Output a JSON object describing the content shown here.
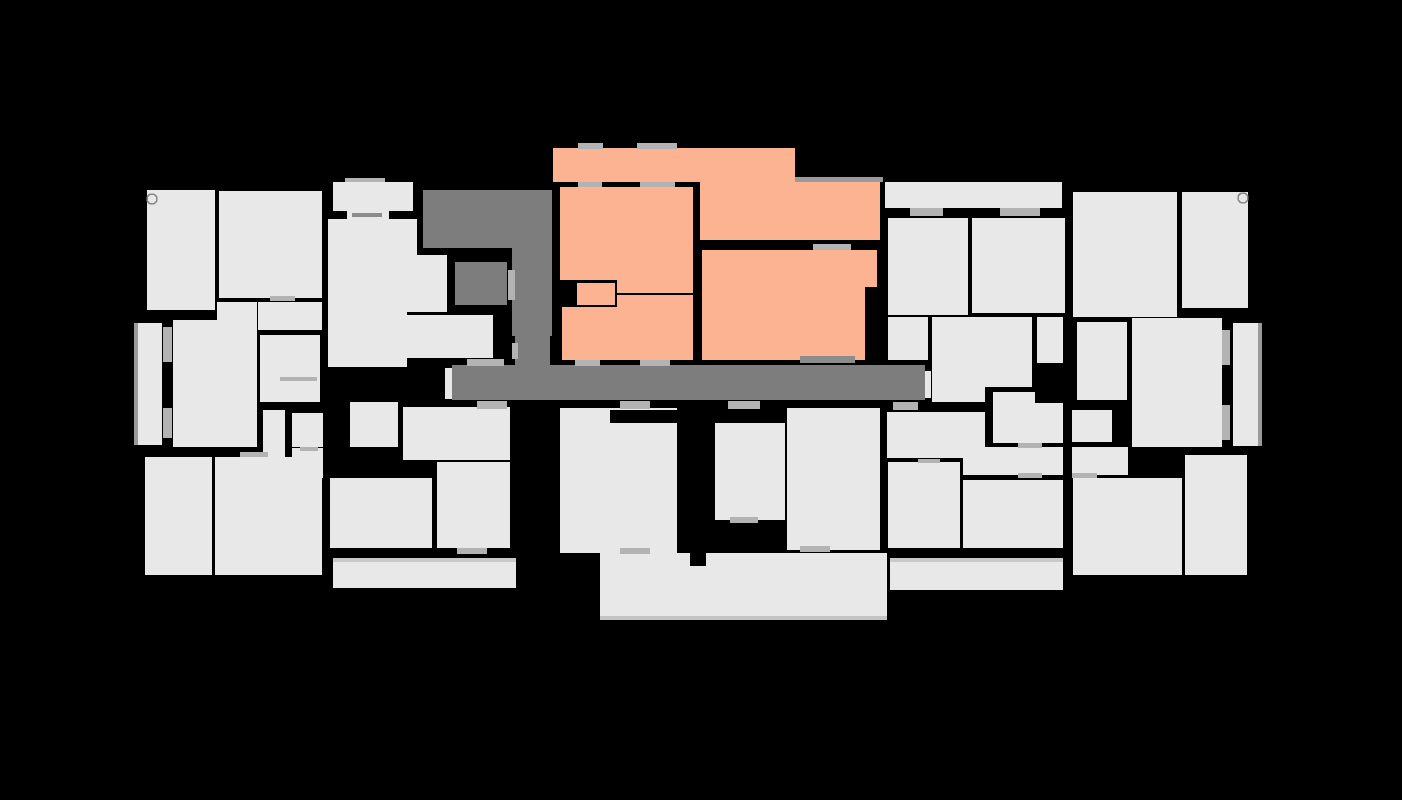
{
  "canvas": {
    "width": 1402,
    "height": 800,
    "background": "#000000"
  },
  "palette": {
    "room": "#e8e8e8",
    "common": "#7d7d7d",
    "unit": "#fbb391",
    "wall": "#000000",
    "door": "#b3b3b3",
    "door_dark": "#8c8c8c",
    "shade": "#9a9a9a",
    "trim": "#c9c9c9",
    "trim_bottom": "#c4c4c4",
    "circle_stroke": "#888888"
  },
  "floorplan": {
    "selected_unit": {
      "id": "unit-orange",
      "color": "#fbb391",
      "room_ids": [
        "u-hall",
        "u-room-ne",
        "u-bedroom",
        "u-wc",
        "u-bath",
        "u-kitchen",
        "u-living"
      ]
    },
    "rooms": [
      {
        "id": "u-hall",
        "kind": "unit",
        "shape": "rect",
        "x": 553,
        "y": 148,
        "w": 242,
        "h": 34
      },
      {
        "id": "u-room-ne",
        "kind": "unit",
        "shape": "rect",
        "x": 700,
        "y": 182,
        "w": 180,
        "h": 58
      },
      {
        "id": "u-bedroom",
        "kind": "unit",
        "shape": "poly",
        "points": "560,187 693,187 693,293 617,293 617,280 560,280"
      },
      {
        "id": "u-wc",
        "kind": "unit",
        "shape": "rect",
        "x": 577,
        "y": 283,
        "w": 38,
        "h": 22
      },
      {
        "id": "u-bath",
        "kind": "unit",
        "shape": "rect",
        "x": 562,
        "y": 307,
        "w": 55,
        "h": 53
      },
      {
        "id": "u-kitchen",
        "kind": "unit",
        "shape": "rect",
        "x": 617,
        "y": 295,
        "w": 76,
        "h": 65
      },
      {
        "id": "u-living",
        "kind": "unit",
        "shape": "poly",
        "points": "702,250 877,250 877,287 865,287 865,360 702,360"
      },
      {
        "id": "c-hall-nw",
        "kind": "common",
        "shape": "rect",
        "x": 423,
        "y": 190,
        "w": 94,
        "h": 58
      },
      {
        "id": "c-strip",
        "kind": "common",
        "shape": "rect",
        "x": 512,
        "y": 190,
        "w": 40,
        "h": 146
      },
      {
        "id": "c-block",
        "kind": "common",
        "shape": "rect",
        "x": 455,
        "y": 262,
        "w": 52,
        "h": 43
      },
      {
        "id": "c-stub",
        "kind": "common",
        "shape": "rect",
        "x": 515,
        "y": 336,
        "w": 35,
        "h": 30
      },
      {
        "id": "c-corridor",
        "kind": "common",
        "shape": "rect",
        "x": 452,
        "y": 365,
        "w": 473,
        "h": 35
      },
      {
        "id": "room-a",
        "kind": "room",
        "shape": "rect",
        "x": 147,
        "y": 190,
        "w": 68,
        "h": 120
      },
      {
        "id": "room-a2",
        "kind": "room",
        "shape": "rect",
        "x": 137,
        "y": 323,
        "w": 25,
        "h": 122
      },
      {
        "id": "room-b",
        "kind": "room",
        "shape": "rect",
        "x": 219,
        "y": 191,
        "w": 103,
        "h": 107
      },
      {
        "id": "room-ctop",
        "kind": "room",
        "shape": "rect",
        "x": 333,
        "y": 182,
        "w": 80,
        "h": 29
      },
      {
        "id": "room-cconn",
        "kind": "room",
        "shape": "rect",
        "x": 347,
        "y": 211,
        "w": 42,
        "h": 10
      },
      {
        "id": "room-d",
        "kind": "room",
        "shape": "poly",
        "points": "328,219 417,219 417,255 447,255 447,312 407,312 407,367 328,367"
      },
      {
        "id": "room-e",
        "kind": "room",
        "shape": "poly",
        "points": "217,302 257,302 257,447 173,447 173,320 217,320"
      },
      {
        "id": "room-f",
        "kind": "room",
        "shape": "rect",
        "x": 258,
        "y": 302,
        "w": 64,
        "h": 28
      },
      {
        "id": "room-g",
        "kind": "room",
        "shape": "rect",
        "x": 260,
        "y": 335,
        "w": 60,
        "h": 67
      },
      {
        "id": "room-sq1",
        "kind": "room",
        "shape": "rect",
        "x": 292,
        "y": 413,
        "w": 31,
        "h": 34
      },
      {
        "id": "room-sq2",
        "kind": "room",
        "shape": "rect",
        "x": 292,
        "y": 448,
        "w": 31,
        "h": 30
      },
      {
        "id": "room-x",
        "kind": "room",
        "shape": "rect",
        "x": 407,
        "y": 315,
        "w": 86,
        "h": 43
      },
      {
        "id": "room-l9",
        "kind": "room",
        "shape": "rect",
        "x": 145,
        "y": 457,
        "w": 67,
        "h": 118
      },
      {
        "id": "room-l10",
        "kind": "room",
        "shape": "poly",
        "points": "263,410 285,410 285,457 322,457 322,575 215,575 215,457 263,457"
      },
      {
        "id": "room-m1",
        "kind": "room",
        "shape": "rect",
        "x": 350,
        "y": 402,
        "w": 48,
        "h": 45
      },
      {
        "id": "room-m2",
        "kind": "room",
        "shape": "rect",
        "x": 403,
        "y": 407,
        "w": 107,
        "h": 53
      },
      {
        "id": "room-m3",
        "kind": "room",
        "shape": "rect",
        "x": 330,
        "y": 478,
        "w": 102,
        "h": 70
      },
      {
        "id": "room-m4",
        "kind": "room",
        "shape": "rect",
        "x": 437,
        "y": 462,
        "w": 73,
        "h": 86
      },
      {
        "id": "room-lbar",
        "kind": "room",
        "shape": "rect",
        "x": 333,
        "y": 558,
        "w": 183,
        "h": 30
      },
      {
        "id": "cap-left",
        "kind": "room",
        "shape": "rect",
        "x": 445,
        "y": 368,
        "w": 7,
        "h": 31
      },
      {
        "id": "room-bc1",
        "kind": "room",
        "shape": "rect",
        "x": 560,
        "y": 408,
        "w": 117,
        "h": 145
      },
      {
        "id": "room-bc2",
        "kind": "room",
        "shape": "rect",
        "x": 715,
        "y": 423,
        "w": 70,
        "h": 97
      },
      {
        "id": "room-bc3",
        "kind": "room",
        "shape": "rect",
        "x": 787,
        "y": 408,
        "w": 93,
        "h": 142
      },
      {
        "id": "room-slab",
        "kind": "room",
        "shape": "rect",
        "x": 600,
        "y": 553,
        "w": 287,
        "h": 67
      },
      {
        "id": "room-r0",
        "kind": "room",
        "shape": "rect",
        "x": 885,
        "y": 182,
        "w": 177,
        "h": 26
      },
      {
        "id": "room-r1",
        "kind": "room",
        "shape": "rect",
        "x": 888,
        "y": 218,
        "w": 80,
        "h": 97
      },
      {
        "id": "room-r2",
        "kind": "room",
        "shape": "rect",
        "x": 972,
        "y": 218,
        "w": 93,
        "h": 95
      },
      {
        "id": "room-r3",
        "kind": "room",
        "shape": "rect",
        "x": 1073,
        "y": 192,
        "w": 104,
        "h": 125
      },
      {
        "id": "room-r4",
        "kind": "room",
        "shape": "rect",
        "x": 1182,
        "y": 192,
        "w": 66,
        "h": 116
      },
      {
        "id": "room-r5",
        "kind": "room",
        "shape": "rect",
        "x": 888,
        "y": 317,
        "w": 40,
        "h": 43
      },
      {
        "id": "room-r6",
        "kind": "room",
        "shape": "poly",
        "points": "932,317 1032,317 1032,387 985,387 985,402 932,402"
      },
      {
        "id": "room-r7",
        "kind": "room",
        "shape": "rect",
        "x": 1037,
        "y": 317,
        "w": 26,
        "h": 46
      },
      {
        "id": "room-r8",
        "kind": "room",
        "shape": "rect",
        "x": 1077,
        "y": 322,
        "w": 50,
        "h": 78
      },
      {
        "id": "room-r9",
        "kind": "room",
        "shape": "rect",
        "x": 1132,
        "y": 318,
        "w": 90,
        "h": 129
      },
      {
        "id": "room-r10",
        "kind": "room",
        "shape": "rect",
        "x": 1233,
        "y": 323,
        "w": 29,
        "h": 123
      },
      {
        "id": "room-r11",
        "kind": "room",
        "shape": "poly",
        "points": "993,392 1035,392 1035,403 1063,403 1063,443 993,443"
      },
      {
        "id": "room-r12",
        "kind": "room",
        "shape": "rect",
        "x": 1072,
        "y": 410,
        "w": 40,
        "h": 32
      },
      {
        "id": "room-q0",
        "kind": "room",
        "shape": "rect",
        "x": 887,
        "y": 412,
        "w": 98,
        "h": 46
      },
      {
        "id": "room-rbar1",
        "kind": "room",
        "shape": "rect",
        "x": 963,
        "y": 447,
        "w": 100,
        "h": 28
      },
      {
        "id": "room-rbar2",
        "kind": "room",
        "shape": "rect",
        "x": 1072,
        "y": 447,
        "w": 56,
        "h": 28
      },
      {
        "id": "room-q1",
        "kind": "room",
        "shape": "rect",
        "x": 888,
        "y": 462,
        "w": 72,
        "h": 86
      },
      {
        "id": "room-q2",
        "kind": "room",
        "shape": "rect",
        "x": 963,
        "y": 480,
        "w": 100,
        "h": 68
      },
      {
        "id": "room-r14",
        "kind": "room",
        "shape": "rect",
        "x": 1073,
        "y": 478,
        "w": 109,
        "h": 97
      },
      {
        "id": "room-r15",
        "kind": "room",
        "shape": "rect",
        "x": 1185,
        "y": 455,
        "w": 62,
        "h": 120
      },
      {
        "id": "room-rbar3",
        "kind": "room",
        "shape": "rect",
        "x": 890,
        "y": 558,
        "w": 173,
        "h": 32
      },
      {
        "id": "cap-right",
        "kind": "room",
        "shape": "rect",
        "x": 925,
        "y": 371,
        "w": 6,
        "h": 27
      }
    ],
    "markers": [
      {
        "id": "window-hall-1",
        "x": 578,
        "y": 143,
        "w": 25,
        "h": 6,
        "fill": "door"
      },
      {
        "id": "window-hall-2",
        "x": 637,
        "y": 143,
        "w": 40,
        "h": 6,
        "fill": "door"
      },
      {
        "id": "window-ctop",
        "x": 345,
        "y": 178,
        "w": 40,
        "h": 4,
        "fill": "door"
      },
      {
        "id": "door-bedroom-1",
        "x": 578,
        "y": 182,
        "w": 24,
        "h": 5,
        "fill": "door"
      },
      {
        "id": "door-bedroom-2",
        "x": 640,
        "y": 182,
        "w": 35,
        "h": 5,
        "fill": "door"
      },
      {
        "id": "door-cconn",
        "x": 352,
        "y": 213,
        "w": 30,
        "h": 4,
        "fill": "door_dark"
      },
      {
        "id": "door-ne-living",
        "x": 813,
        "y": 244,
        "w": 38,
        "h": 6,
        "fill": "door"
      },
      {
        "id": "door-living-corr",
        "x": 800,
        "y": 356,
        "w": 55,
        "h": 7,
        "fill": "door_dark"
      },
      {
        "id": "door-bath-corr",
        "x": 575,
        "y": 360,
        "w": 25,
        "h": 6,
        "fill": "door"
      },
      {
        "id": "door-kitchen",
        "x": 640,
        "y": 360,
        "w": 30,
        "h": 6,
        "fill": "door"
      },
      {
        "id": "door-xroom",
        "x": 467,
        "y": 359,
        "w": 37,
        "h": 7,
        "fill": "door"
      },
      {
        "id": "door-strip-w",
        "x": 508,
        "y": 270,
        "w": 7,
        "h": 30,
        "fill": "door"
      },
      {
        "id": "door-strip-s",
        "x": 512,
        "y": 343,
        "w": 6,
        "h": 16,
        "fill": "door"
      },
      {
        "id": "door-corr-1",
        "x": 477,
        "y": 401,
        "w": 30,
        "h": 8,
        "fill": "door"
      },
      {
        "id": "door-corr-2",
        "x": 620,
        "y": 401,
        "w": 30,
        "h": 8,
        "fill": "door"
      },
      {
        "id": "door-corr-3",
        "x": 728,
        "y": 401,
        "w": 32,
        "h": 8,
        "fill": "door"
      },
      {
        "id": "door-corr-4",
        "x": 893,
        "y": 402,
        "w": 25,
        "h": 8,
        "fill": "door"
      },
      {
        "id": "door-r0-1",
        "x": 910,
        "y": 208,
        "w": 33,
        "h": 8,
        "fill": "door"
      },
      {
        "id": "door-r0-2",
        "x": 1000,
        "y": 208,
        "w": 40,
        "h": 8,
        "fill": "door"
      },
      {
        "id": "door-a2-1",
        "x": 163,
        "y": 327,
        "w": 9,
        "h": 35,
        "fill": "door"
      },
      {
        "id": "door-a2-2",
        "x": 163,
        "y": 408,
        "w": 9,
        "h": 30,
        "fill": "door"
      },
      {
        "id": "door-r9-1",
        "x": 1222,
        "y": 330,
        "w": 8,
        "h": 35,
        "fill": "door"
      },
      {
        "id": "door-r9-2",
        "x": 1222,
        "y": 405,
        "w": 8,
        "h": 35,
        "fill": "door"
      },
      {
        "id": "door-b",
        "x": 270,
        "y": 296,
        "w": 25,
        "h": 5,
        "fill": "door"
      },
      {
        "id": "line-g",
        "x": 280,
        "y": 377,
        "w": 37,
        "h": 4,
        "fill": "door"
      },
      {
        "id": "door-bc1",
        "x": 620,
        "y": 548,
        "w": 30,
        "h": 6,
        "fill": "door"
      },
      {
        "id": "door-bc2",
        "x": 730,
        "y": 517,
        "w": 28,
        "h": 6,
        "fill": "door"
      },
      {
        "id": "door-bc3",
        "x": 800,
        "y": 546,
        "w": 30,
        "h": 6,
        "fill": "door"
      },
      {
        "id": "door-l10",
        "x": 240,
        "y": 452,
        "w": 28,
        "h": 5,
        "fill": "door"
      },
      {
        "id": "door-m2",
        "x": 478,
        "y": 402,
        "w": 22,
        "h": 5,
        "fill": "door"
      },
      {
        "id": "door-m4",
        "x": 457,
        "y": 548,
        "w": 30,
        "h": 6,
        "fill": "door"
      },
      {
        "id": "door-sq",
        "x": 300,
        "y": 447,
        "w": 18,
        "h": 4,
        "fill": "door"
      },
      {
        "id": "door-q1",
        "x": 918,
        "y": 459,
        "w": 22,
        "h": 4,
        "fill": "door"
      },
      {
        "id": "door-r11",
        "x": 1018,
        "y": 443,
        "w": 24,
        "h": 5,
        "fill": "door"
      },
      {
        "id": "door-rbar1",
        "x": 1018,
        "y": 473,
        "w": 24,
        "h": 5,
        "fill": "door"
      },
      {
        "id": "door-rbar2",
        "x": 1072,
        "y": 473,
        "w": 25,
        "h": 5,
        "fill": "door"
      },
      {
        "id": "shade-ne",
        "x": 795,
        "y": 177,
        "w": 88,
        "h": 5,
        "fill": "shade"
      },
      {
        "id": "shade-r10",
        "x": 1258,
        "y": 323,
        "w": 4,
        "h": 123,
        "fill": "shade"
      },
      {
        "id": "shade-a2",
        "x": 134,
        "y": 323,
        "w": 4,
        "h": 122,
        "fill": "shade"
      },
      {
        "id": "trim-slab",
        "x": 600,
        "y": 616,
        "w": 287,
        "h": 4,
        "fill": "trim_bottom"
      },
      {
        "id": "trim-lbar",
        "x": 333,
        "y": 558,
        "w": 183,
        "h": 4,
        "fill": "trim"
      },
      {
        "id": "trim-rbar",
        "x": 890,
        "y": 558,
        "w": 173,
        "h": 4,
        "fill": "trim"
      },
      {
        "id": "wall-bc1",
        "x": 610,
        "y": 410,
        "w": 67,
        "h": 13,
        "fill": "wall"
      },
      {
        "id": "wall-stem",
        "x": 690,
        "y": 548,
        "w": 16,
        "h": 18,
        "fill": "wall"
      }
    ],
    "circles": [
      {
        "id": "door-swing-a",
        "cx": 152,
        "cy": 199,
        "r": 5
      },
      {
        "id": "door-swing-r4",
        "cx": 1243,
        "cy": 198,
        "r": 5
      }
    ]
  }
}
